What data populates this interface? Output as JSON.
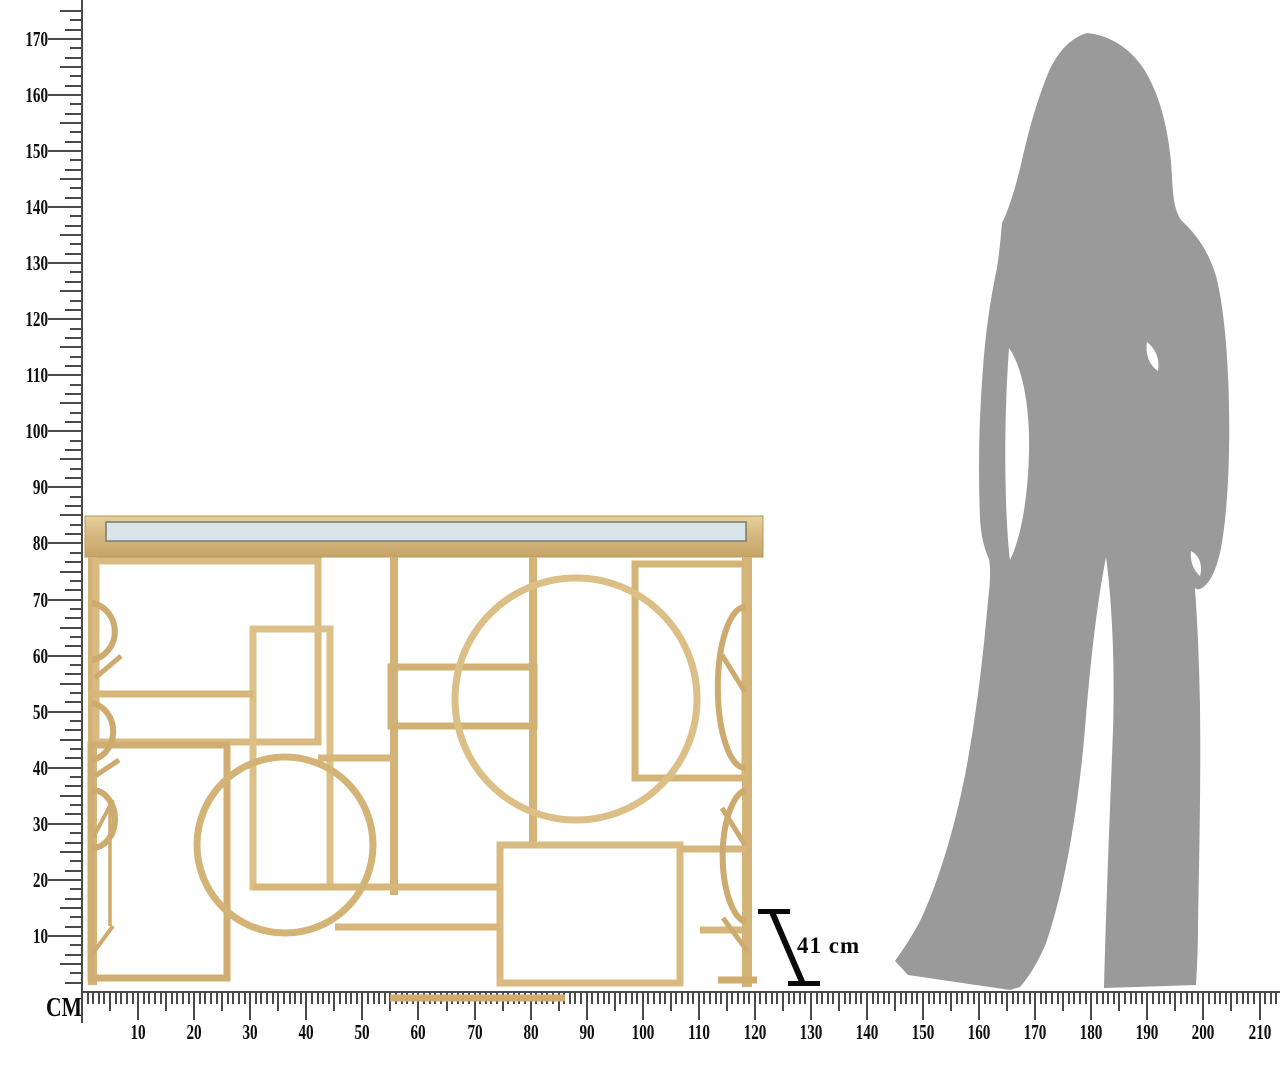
{
  "rulers": {
    "unit_label": "CM",
    "vertical_labels": [
      "10",
      "20",
      "30",
      "40",
      "50",
      "60",
      "70",
      "80",
      "90",
      "100",
      "110",
      "120",
      "130",
      "140",
      "150",
      "160",
      "170"
    ],
    "horizontal_labels": [
      "10",
      "20",
      "30",
      "40",
      "50",
      "60",
      "70",
      "80",
      "90",
      "100",
      "110",
      "120",
      "130",
      "140",
      "150",
      "160",
      "170",
      "180",
      "190",
      "200",
      "210"
    ]
  },
  "dimension_annotation": {
    "text": "41 cm"
  },
  "illustration": {
    "table": "gold-geometric-console-table-with-mirror-top",
    "figure": "female-silhouette-for-scale"
  },
  "colors": {
    "gold": "#d7b77d",
    "gold_dark": "#c8a76a",
    "gold_light": "#e9d6a4",
    "mirror": "#d9e5e9",
    "silhouette_gray": "#9a9a9a",
    "tick_gray": "#4a4a4a",
    "label_black": "#0d0d0d"
  }
}
